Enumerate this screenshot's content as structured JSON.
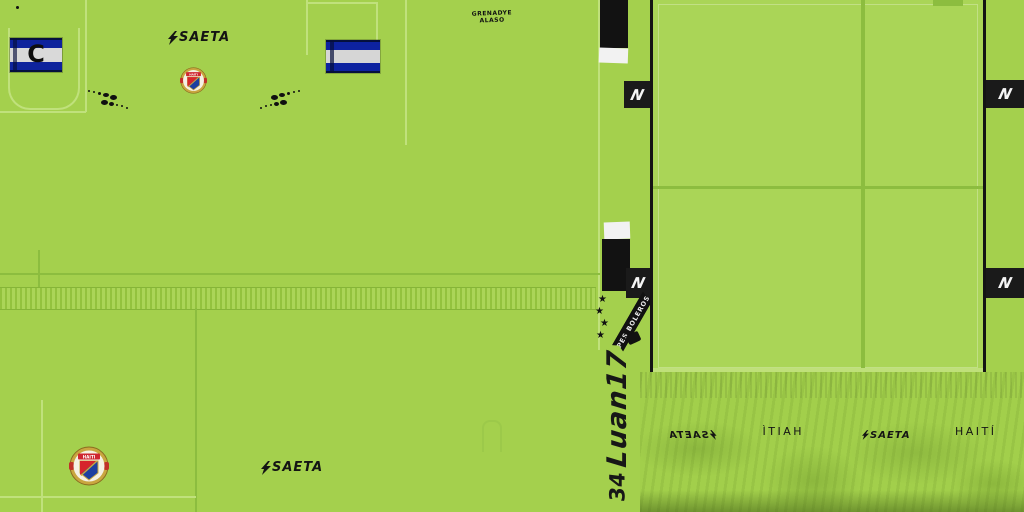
{
  "meta": {
    "description": "football kit texture sheet"
  },
  "colors": {
    "background_green": "#a4d04d",
    "panel_green": "#aad557",
    "seam_light": "#c0e17c",
    "seam_dark": "#8cbd3f",
    "black": "#141414",
    "white": "#f2f2f2",
    "flag_navy": "#0d22a0",
    "crest_red": "#d6252c",
    "crest_blue": "#1d3fa0",
    "crest_gold": "#c9a63f"
  },
  "shirt": {
    "brand": "SAETA",
    "captain_letter": "C",
    "crest_text": "HAITI",
    "neck_label": {
      "line1": "GRENADYE",
      "line2": "ALASO"
    }
  },
  "bottom_left": {
    "brand": "SAETA",
    "crest_text": "HAITI"
  },
  "side_strip": {
    "player_name": "Luan17",
    "player_number": "34",
    "ribbon_text": "PES BOLEROS",
    "star_icon": "★"
  },
  "shorts": {
    "n_marks": [
      "N",
      "N",
      "N",
      "N"
    ]
  },
  "waistband": {
    "labels": [
      {
        "text": "SAETA",
        "style": "brand",
        "mirrored": true
      },
      {
        "text": "HAITÍ",
        "style": "plain",
        "mirrored": true
      },
      {
        "text": "SAETA",
        "style": "brand",
        "mirrored": false
      },
      {
        "text": "HAITÍ",
        "style": "plain",
        "mirrored": false
      }
    ]
  }
}
